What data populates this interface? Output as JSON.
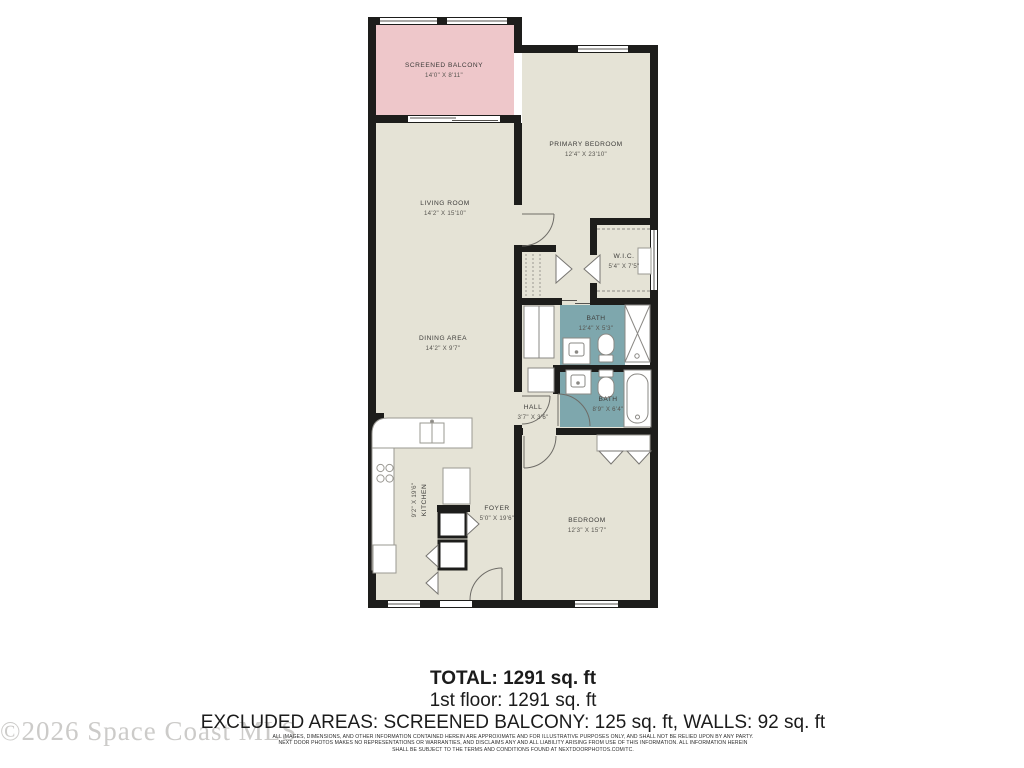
{
  "floorplan": {
    "rooms": {
      "screened_balcony": {
        "label": "SCREENED BALCONY",
        "dims": "14'0\" X 8'11\""
      },
      "primary_bedroom": {
        "label": "PRIMARY BEDROOM",
        "dims": "12'4\" X 23'10\""
      },
      "living_room": {
        "label": "LIVING ROOM",
        "dims": "14'2\" X 15'10\""
      },
      "wic": {
        "label": "W.I.C.",
        "dims": "5'4\" X 7'5\""
      },
      "bath_primary": {
        "label": "BATH",
        "dims": "12'4\" X 5'3\""
      },
      "dining_area": {
        "label": "DINING AREA",
        "dims": "14'2\" X 9'7\""
      },
      "bath_hall": {
        "label": "BATH",
        "dims": "8'9\" X 6'4\""
      },
      "hall": {
        "label": "HALL",
        "dims": "3'7\" X 3'6\""
      },
      "kitchen": {
        "label": "KITCHEN",
        "dims": "9'2\" X 19'6\""
      },
      "foyer": {
        "label": "FOYER",
        "dims": "5'0\" X 19'6\""
      },
      "bedroom": {
        "label": "BEDROOM",
        "dims": "12'3\" X 15'7\""
      }
    },
    "colors": {
      "floor": "#e5e3d6",
      "balcony": "#eec7ca",
      "bath": "#7ea7ad",
      "wall": "#1d1d1b"
    }
  },
  "summary": {
    "total": "TOTAL: 1291 sq. ft",
    "floor1": "1st floor: 1291 sq. ft",
    "excluded": "EXCLUDED AREAS: SCREENED BALCONY: 125 sq. ft, WALLS: 92 sq. ft"
  },
  "watermark": "©2026 Space Coast MLS",
  "disclaimer": {
    "line1": "ALL IMAGES, DIMENSIONS, AND OTHER INFORMATION CONTAINED HEREIN ARE APPROXIMATE AND FOR ILLUSTRATIVE PURPOSES ONLY, AND SHALL NOT BE RELIED UPON BY ANY PARTY.",
    "line2": "NEXT DOOR PHOTOS MAKES NO REPRESENTATIONS OR WARRANTIES, AND DISCLAIMS ANY AND ALL LIABILITY ARISING FROM USE OF THIS INFORMATION. ALL INFORMATION HEREIN",
    "line3": "SHALL BE SUBJECT TO THE TERMS AND CONDITIONS FOUND AT NEXTDOORPHOTOS.COM/TC."
  }
}
